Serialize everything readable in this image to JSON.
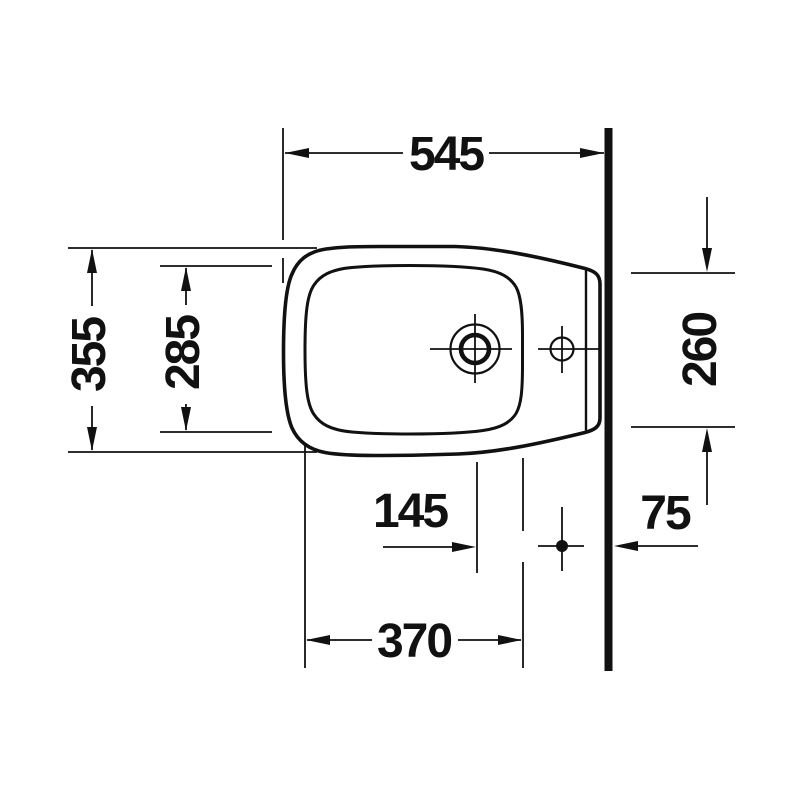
{
  "drawing": {
    "subject": "bidet-top-view-installation-drawing",
    "colors": {
      "line": "#111111",
      "background": "#ffffff"
    },
    "dimensions": {
      "overall_depth": "545",
      "overall_width": "355",
      "inner_width": "285",
      "rear_width": "260",
      "tap_offset": "145",
      "wall_offset": "75",
      "basin_length": "370"
    }
  }
}
